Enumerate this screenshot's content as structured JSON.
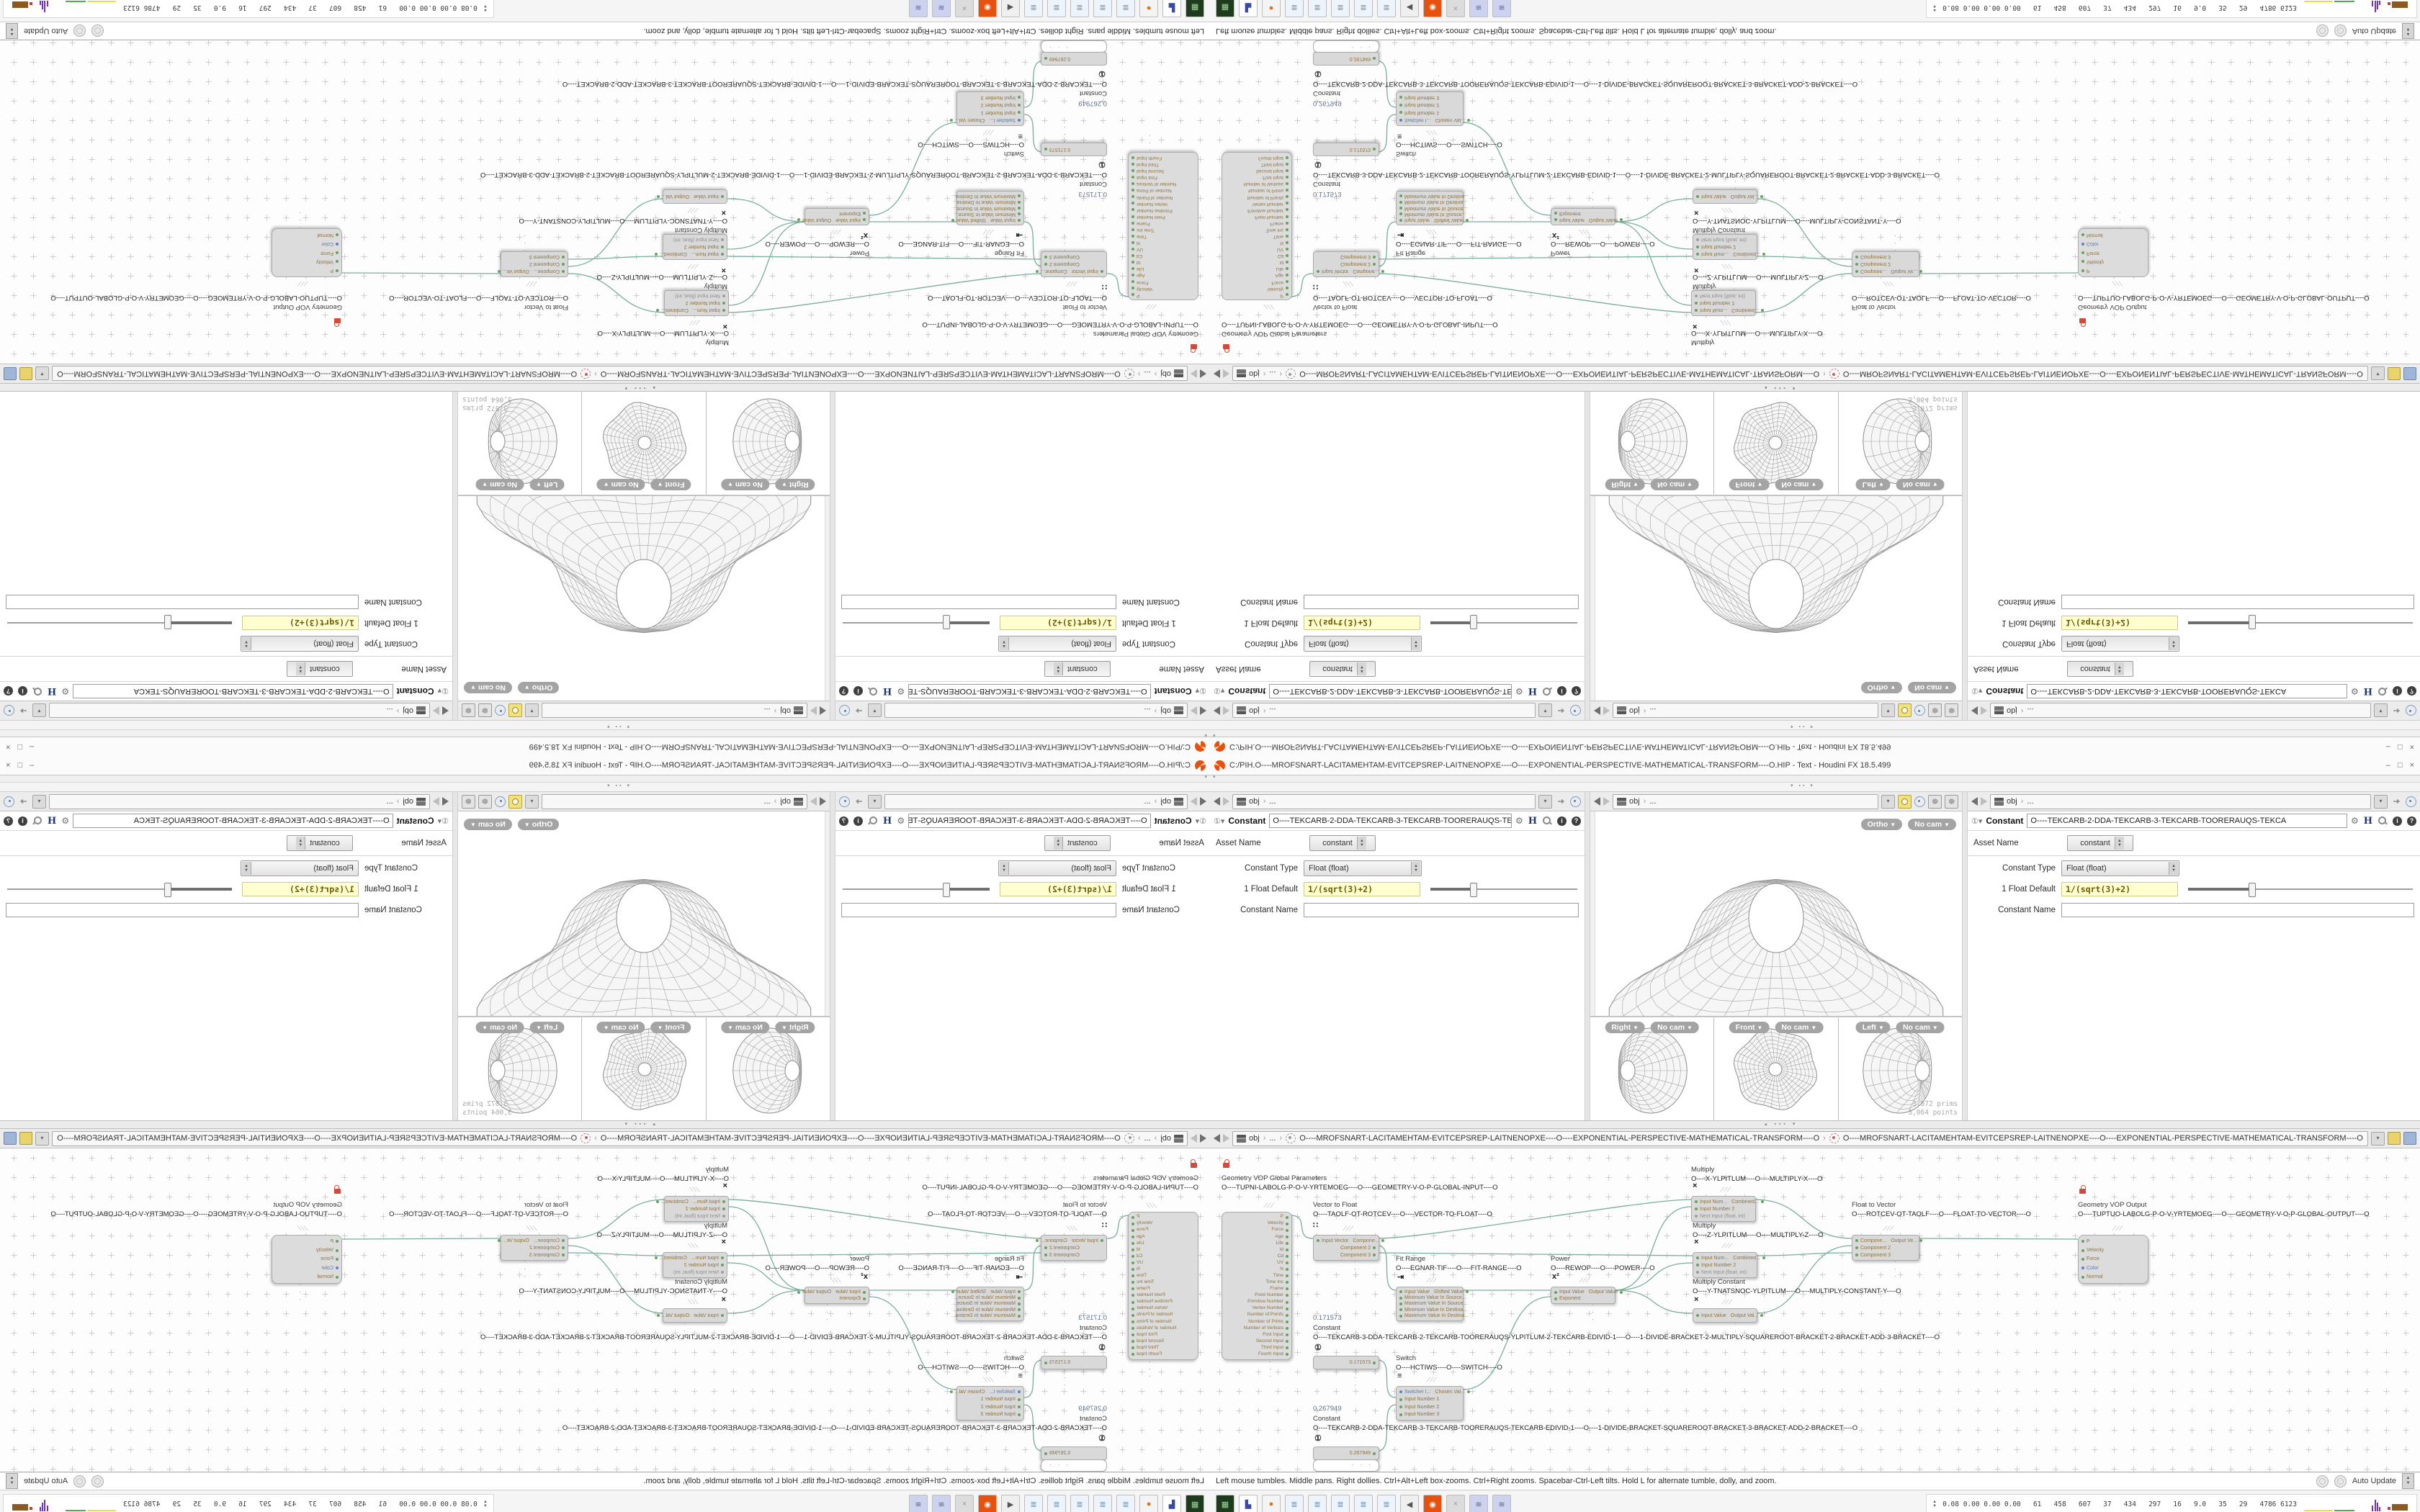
{
  "window": {
    "title": "C:/PIH.O----MROFSNART-LACITAMEHTAM-EVITCEPSREP-LAITNENOPXE----O----EXPONENTIAL-PERSPECTIVE-MATHEMATICAL-TRANSFORM----O.HIP - Text - Houdini FX 18.5.499",
    "minimize": "–",
    "maximize": "□",
    "close": "×"
  },
  "pathbar": {
    "root": "obj",
    "sep": "›",
    "ellipsis": "...",
    "dropdown": "▾"
  },
  "param": {
    "header_title": "Constant",
    "node_name": "O----TEKCARB-2-DDA-TEKCARB-3-TEKCARB-TOORERAUQS-TEKCA",
    "help_i": "i",
    "help_q": "?",
    "h_icon": "H",
    "gear": "⚙",
    "asset_name_label": "Asset Name",
    "asset_name_value": "constant",
    "type_label": "Constant Type",
    "type_value": "Float (float)",
    "default_label": "1 Float Default",
    "default_value": "1/(sqrt(3)+2)",
    "name_label": "Constant Name",
    "name_value": ""
  },
  "viewport": {
    "persp_view": "Ortho",
    "persp_cam": "No cam",
    "views": [
      {
        "label": "Right",
        "cam": "No cam"
      },
      {
        "label": "Front",
        "cam": "No cam"
      },
      {
        "label": "Left",
        "cam": "No cam"
      }
    ],
    "stats_prims": "3,072  prims",
    "stats_points": "3,064 points"
  },
  "netbar": {
    "crumb1": "O----MROFSNART-LACITAMEHTAM-EVITCEPSREP-LAITNENOPXE----O----EXPONENTIAL-PERSPECTIVE-MATHEMATICAL-TRANSFORM----O",
    "crumb2": "O----MROFSNART-LACITAMEHTAM-EVITCEPSREP-LAITNENOPXE----O----EXPONENTIAL-PERSPECTIVE-MATHEMATICAL-TRANSFORM----O"
  },
  "netgraph": {
    "nodes": [
      {
        "id": "gp",
        "title": "Geometry VOP Global Parameters",
        "name": "O----TUPNI-LABOLG-P-O-V-YRTEMOEG----O----GEOMETRY-V-O-P-GLOBAL-INPUT----O",
        "lock": true,
        "ports": [
          {
            "r": "P",
            "c": "g"
          },
          {
            "r": "Velocity",
            "c": "g"
          },
          {
            "r": "Force",
            "c": "g"
          },
          {
            "r": "Age",
            "c": "g"
          },
          {
            "r": "Life",
            "c": "g"
          },
          {
            "r": "Id",
            "c": "b"
          },
          {
            "r": "Cd",
            "c": "g"
          },
          {
            "r": "UV",
            "c": "g"
          },
          {
            "r": "N",
            "c": "g"
          },
          {
            "r": "Time",
            "c": "g"
          },
          {
            "r": "Time Inc",
            "c": "g"
          },
          {
            "r": "Frame",
            "c": "g"
          },
          {
            "r": "Point Number",
            "c": "b"
          },
          {
            "r": "Primitive Number",
            "c": "b"
          },
          {
            "r": "Vertex Number",
            "c": "b"
          },
          {
            "r": "Number of Points",
            "c": "b"
          },
          {
            "r": "Number of Prims",
            "c": "b"
          },
          {
            "r": "Number of Vertices",
            "c": "b"
          },
          {
            "r": "First Input",
            "c": "o"
          },
          {
            "r": "Second Input",
            "c": "o"
          },
          {
            "r": "Third Input",
            "c": "o"
          },
          {
            "r": "Fourth Input",
            "c": "o"
          }
        ]
      },
      {
        "id": "v2f",
        "title": "Vector to Float",
        "name": "O----TAOLF-OT-ROTCEV----O----VECTOR-TO-FLOAT----O",
        "icon": "∷",
        "ports": [
          {
            "l": "Input Vector",
            "lc": "g",
            "r": "Compone...",
            "rc": "g"
          },
          {
            "r": "Component 2",
            "rc": "g"
          },
          {
            "r": "Component 3",
            "rc": "g"
          }
        ]
      },
      {
        "id": "multx",
        "title": "Multiply",
        "name": "O----X-YLPITLUM----O----MULTIPLY-X----O",
        "icon": "×",
        "ports": [
          {
            "l": "Input Num...",
            "lc": "g",
            "r": "Combined...",
            "rc": "g"
          },
          {
            "l": "Input Number 2",
            "lc": "g"
          },
          {
            "l": "Next Input (float, int)",
            "lc": "gr"
          }
        ]
      },
      {
        "id": "multz",
        "title": "Multiply",
        "name": "O----Z-YLPITLUM----O----MULTIPLY-Z----O",
        "icon": "×",
        "ports": [
          {
            "l": "Input Num...",
            "lc": "g",
            "r": "Combined...",
            "rc": "g"
          },
          {
            "l": "Input Number 2",
            "lc": "g"
          },
          {
            "l": "Next Input (float, int)",
            "lc": "gr"
          }
        ]
      },
      {
        "id": "fit",
        "title": "Fit Range",
        "name": "O----EGNAR-TIF----O----FIT-RANGE----O",
        "icon": "⇥",
        "ports": [
          {
            "l": "Input Value",
            "lc": "g",
            "r": "Shifted Value",
            "rc": "g"
          },
          {
            "l": "Minimum Value In Source...",
            "lc": "g"
          },
          {
            "l": "Maximum Value In Source...",
            "lc": "g"
          },
          {
            "l": "Minimum Value In Destina...",
            "lc": "g"
          },
          {
            "l": "Maximum Value In Destina...",
            "lc": "g"
          }
        ]
      },
      {
        "id": "power",
        "title": "Power",
        "name": "O----REWOP----O----POWER----O",
        "icon": "x²",
        "ports": [
          {
            "l": "Input Value",
            "lc": "g",
            "r": "Output Value",
            "rc": "g"
          },
          {
            "l": "Exponent",
            "lc": "g"
          }
        ]
      },
      {
        "id": "multc",
        "title": "Multiply Constant",
        "name": "O----Y-TNATSNOC-YLPITLUM----O----MULTIPLY-CONSTANT-Y----O",
        "icon": "×",
        "ports": [
          {
            "l": "Input Value",
            "lc": "g",
            "r": "Output Val...",
            "rc": "g"
          }
        ]
      },
      {
        "id": "f2v",
        "title": "Float to Vector",
        "name": "O----ROTCEV-OT-TAOLF----O----FLOAT-TO-VECTOR----O",
        "ports": [
          {
            "l": "Compone...",
            "lc": "g",
            "r": "Output Ve...",
            "rc": "g"
          },
          {
            "l": "Component 2",
            "lc": "g"
          },
          {
            "l": "Component 3",
            "lc": "g"
          }
        ]
      },
      {
        "id": "out",
        "title": "Geometry VOP Output",
        "name": "O----TUPTUO-LABOLG-P-O-V-YRTEMOEG----O----GEOMETRY-V-O-P-GLOBAL-OUTPUT----O",
        "lock": true,
        "ports": [
          {
            "l": "P",
            "lc": "g"
          },
          {
            "l": "Velocity",
            "lc": "g"
          },
          {
            "l": "Force",
            "lc": "g"
          },
          {
            "l": "Color",
            "lc": "b"
          },
          {
            "l": "Normal",
            "lc": "g"
          }
        ]
      },
      {
        "id": "const1",
        "title": "Constant",
        "value": "0.171573",
        "name": "O----TEKCARB-3-DDA-TEKCARB-2-TEKCARB-TOORERAUQS-YLPITLUM-2-TEKCARB-EDIVID-1----O----1-DIVIDE-BRACKET-2-MULTIPLY-SQUAREROOT-BRACKET-2-BRACKET-ADD-3-BRACKET----O",
        "icon": "①",
        "ports": [
          {
            "r": "0.171573",
            "rc": "g"
          }
        ]
      },
      {
        "id": "switch",
        "title": "Switch",
        "name": "O----HCTIWS----O----SWITCH----O",
        "icon": "≡",
        "ports": [
          {
            "l": "Switcher I...",
            "lc": "b",
            "r": "Chosen Val...",
            "rc": "g"
          },
          {
            "l": "Input Number 1",
            "lc": "g"
          },
          {
            "l": "Input Number 2",
            "lc": "g"
          },
          {
            "l": "Input Number 3",
            "lc": "g"
          }
        ]
      },
      {
        "id": "const2",
        "title": "Constant",
        "value": "0.267949",
        "name": "O----TEKCARB-2-DDA-TEKCARB-3-TEKCARB-TOORERAUQS-TEKCARB-EDIVID-1----O----1-DIVIDE-BRACKET-SQUAREROOT-BRACKET-3-BRACKET-ADD-2-BRACKET----O",
        "icon": "①",
        "extra_box": true,
        "ports": [
          {
            "r": "0.267949",
            "rc": "g"
          }
        ]
      }
    ]
  },
  "helpbar": {
    "text": "Left mouse tumbles. Middle pans. Right dollies. Ctrl+Alt+Left box-zooms. Ctrl+Right zooms. Spacebar-Ctrl-Left tilts. Hold L for alternate tumble, dolly, and zoom.",
    "auto_update": "Auto Update"
  },
  "taskbar": {
    "icons": [
      "launcher",
      "save",
      "firefox",
      "notes",
      "notes",
      "notes",
      "notes",
      "notes",
      "volume",
      "houdini",
      "inactive",
      "script",
      "script"
    ]
  },
  "tray": {
    "stats": "0.08 0.00 0.00 0.00   61   458   607   37   434   297   16   9.0   35   29   4786 6123"
  }
}
